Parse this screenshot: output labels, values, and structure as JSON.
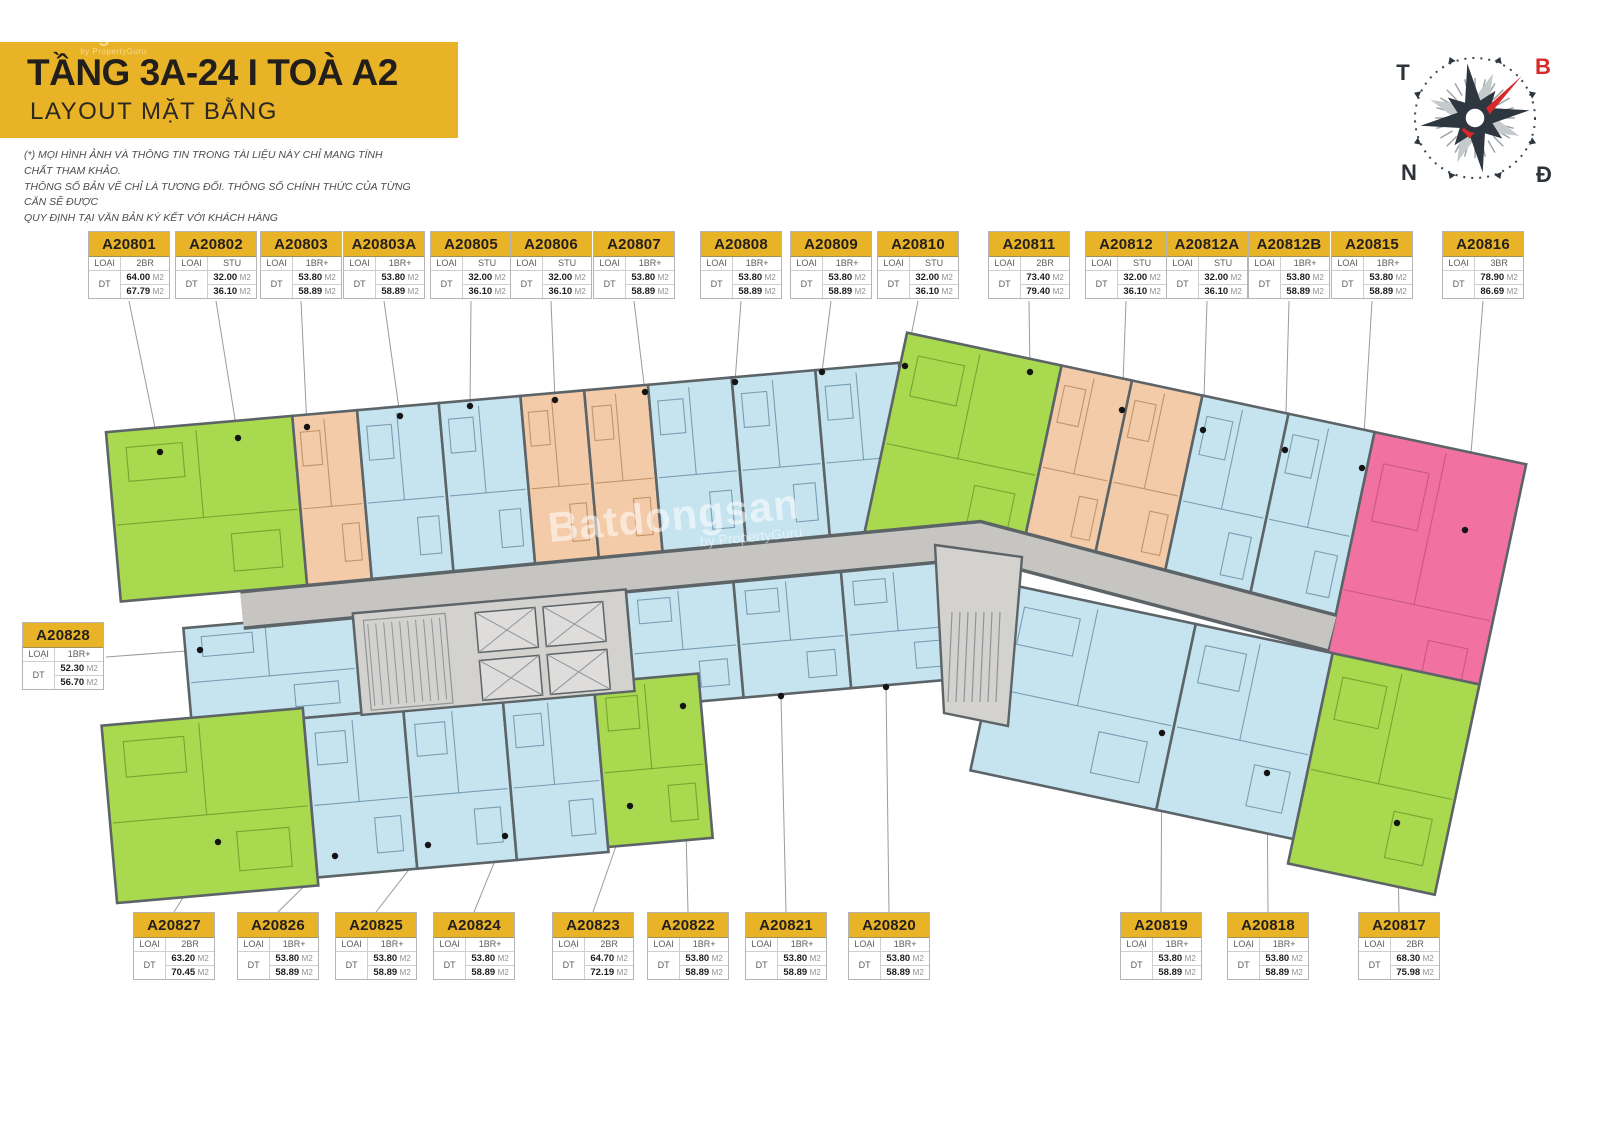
{
  "header": {
    "title": "TẦNG 3A-24 I TOÀ A2",
    "subtitle": "LAYOUT MẶT BẰNG",
    "disclaimer": [
      "(*) MỌI HÌNH ẢNH VÀ THÔNG TIN TRONG TÀI LIỆU NÀY CHỈ MANG TÍNH CHẤT THAM KHẢO.",
      "THÔNG SỐ BẢN VẼ CHỈ LÀ TƯƠNG ĐỐI. THÔNG SỐ CHÍNH THỨC CỦA TỪNG CĂN SẼ ĐƯỢC",
      "QUY ĐỊNH TẠI VĂN BẢN KÝ KẾT VỚI KHÁCH HÀNG"
    ]
  },
  "watermark": {
    "brand": "Batdongsan",
    "sub": "by PropertyGuru"
  },
  "compass": {
    "west": "T",
    "north": "B",
    "south": "N",
    "east": "Đ"
  },
  "legend": {
    "type_label": "LOẠI CH",
    "area_label": "DT",
    "unit_suffix": "M2"
  },
  "colors": {
    "accent_yellow": "#e9b327",
    "unit_blue": "#c6e4f0",
    "unit_green": "#a9d94e",
    "unit_orange": "#f3cba9",
    "unit_pink": "#f172a0",
    "corridor_gray": "#c7c5c2",
    "core_gray": "#d3d2cf",
    "wall": "#5c6468"
  },
  "units": [
    {
      "id": "A20801",
      "type": "2BR",
      "area1": "64.00",
      "area2": "67.79",
      "color": "green"
    },
    {
      "id": "A20802",
      "type": "STU",
      "area1": "32.00",
      "area2": "36.10",
      "color": "orange"
    },
    {
      "id": "A20803",
      "type": "1BR+",
      "area1": "53.80",
      "area2": "58.89",
      "color": "blue"
    },
    {
      "id": "A20803A",
      "type": "1BR+",
      "area1": "53.80",
      "area2": "58.89",
      "color": "blue"
    },
    {
      "id": "A20805",
      "type": "STU",
      "area1": "32.00",
      "area2": "36.10",
      "color": "orange"
    },
    {
      "id": "A20806",
      "type": "STU",
      "area1": "32.00",
      "area2": "36.10",
      "color": "orange"
    },
    {
      "id": "A20807",
      "type": "1BR+",
      "area1": "53.80",
      "area2": "58.89",
      "color": "blue"
    },
    {
      "id": "A20808",
      "type": "1BR+",
      "area1": "53.80",
      "area2": "58.89",
      "color": "blue"
    },
    {
      "id": "A20809",
      "type": "1BR+",
      "area1": "53.80",
      "area2": "58.89",
      "color": "blue"
    },
    {
      "id": "A20810",
      "type": "STU",
      "area1": "32.00",
      "area2": "36.10",
      "color": "orange"
    },
    {
      "id": "A20811",
      "type": "2BR",
      "area1": "73.40",
      "area2": "79.40",
      "color": "green"
    },
    {
      "id": "A20812",
      "type": "STU",
      "area1": "32.00",
      "area2": "36.10",
      "color": "orange"
    },
    {
      "id": "A20812A",
      "type": "STU",
      "area1": "32.00",
      "area2": "36.10",
      "color": "orange"
    },
    {
      "id": "A20812B",
      "type": "1BR+",
      "area1": "53.80",
      "area2": "58.89",
      "color": "blue"
    },
    {
      "id": "A20815",
      "type": "1BR+",
      "area1": "53.80",
      "area2": "58.89",
      "color": "blue"
    },
    {
      "id": "A20816",
      "type": "3BR",
      "area1": "78.90",
      "area2": "86.69",
      "color": "pink"
    },
    {
      "id": "A20828",
      "type": "1BR+",
      "area1": "52.30",
      "area2": "56.70",
      "color": "blue"
    },
    {
      "id": "A20827",
      "type": "2BR",
      "area1": "63.20",
      "area2": "70.45",
      "color": "green"
    },
    {
      "id": "A20826",
      "type": "1BR+",
      "area1": "53.80",
      "area2": "58.89",
      "color": "blue"
    },
    {
      "id": "A20825",
      "type": "1BR+",
      "area1": "53.80",
      "area2": "58.89",
      "color": "blue"
    },
    {
      "id": "A20824",
      "type": "1BR+",
      "area1": "53.80",
      "area2": "58.89",
      "color": "blue"
    },
    {
      "id": "A20823",
      "type": "2BR",
      "area1": "64.70",
      "area2": "72.19",
      "color": "green"
    },
    {
      "id": "A20822",
      "type": "1BR+",
      "area1": "53.80",
      "area2": "58.89",
      "color": "blue"
    },
    {
      "id": "A20821",
      "type": "1BR+",
      "area1": "53.80",
      "area2": "58.89",
      "color": "blue"
    },
    {
      "id": "A20820",
      "type": "1BR+",
      "area1": "53.80",
      "area2": "58.89",
      "color": "blue"
    },
    {
      "id": "A20819",
      "type": "1BR+",
      "area1": "53.80",
      "area2": "58.89",
      "color": "blue"
    },
    {
      "id": "A20818",
      "type": "1BR+",
      "area1": "53.80",
      "area2": "58.89",
      "color": "blue"
    },
    {
      "id": "A20817",
      "type": "2BR",
      "area1": "68.30",
      "area2": "75.98",
      "color": "green"
    }
  ]
}
